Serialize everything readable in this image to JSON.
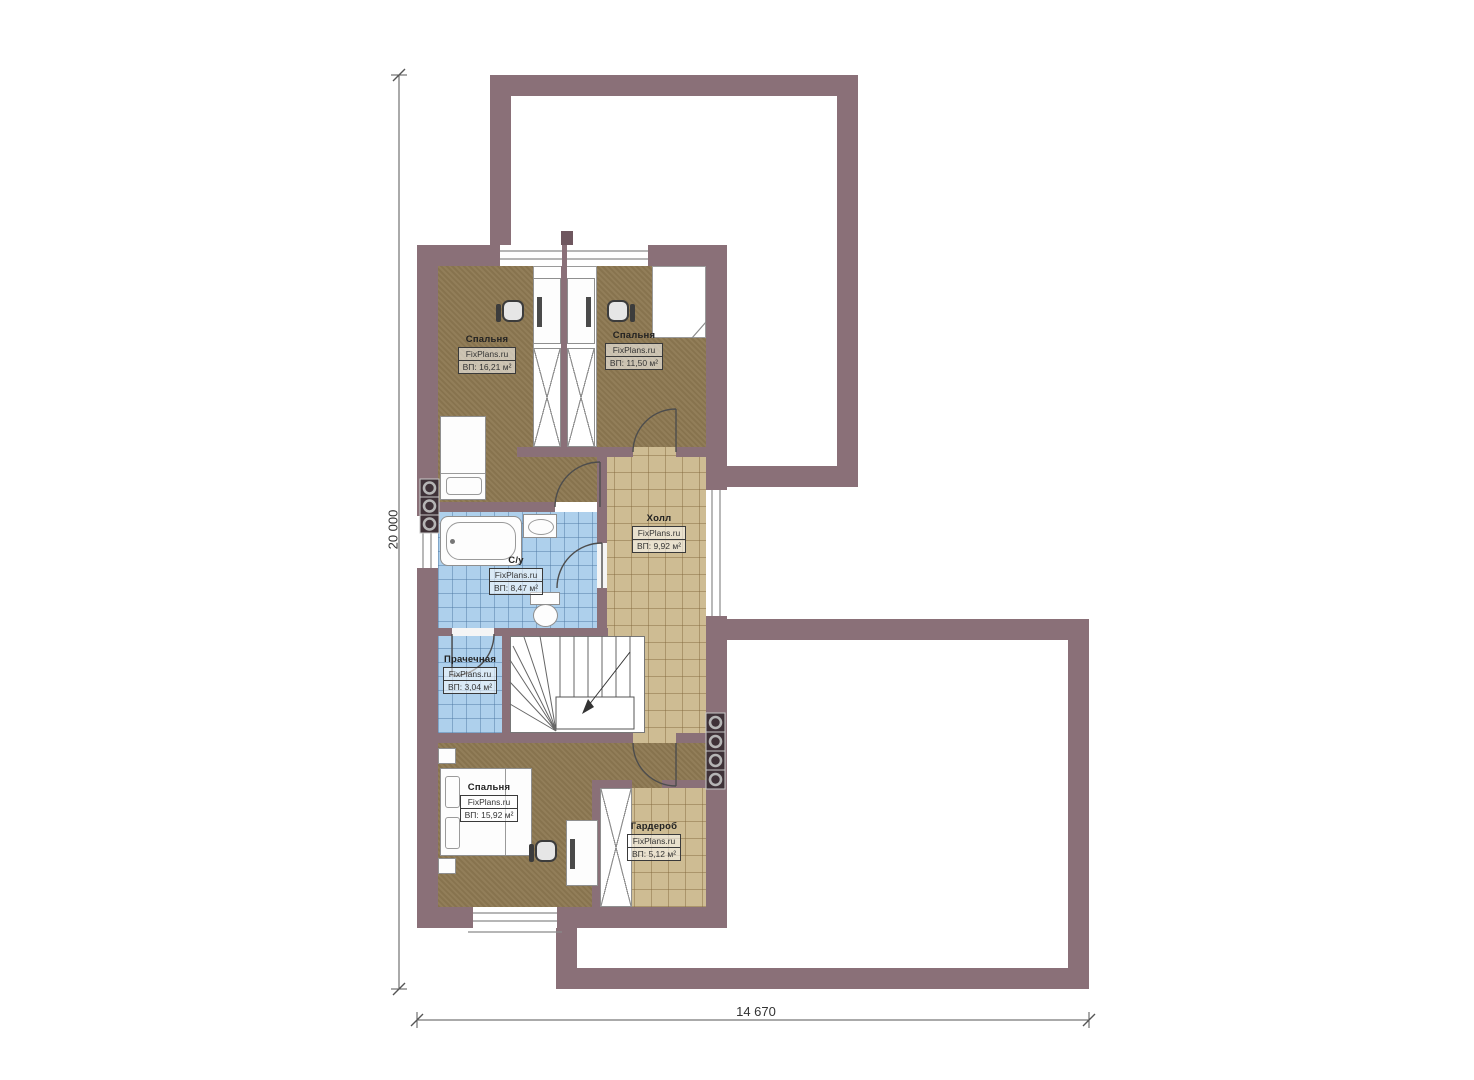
{
  "plan": {
    "rooms": [
      {
        "id": "bedroom-top-left",
        "name": "Спальня",
        "brand": "FixPlans.ru",
        "area": "ВП: 16,21 м²"
      },
      {
        "id": "bedroom-top-right",
        "name": "Спальня",
        "brand": "FixPlans.ru",
        "area": "ВП: 11,50 м²"
      },
      {
        "id": "hall",
        "name": "Холл",
        "brand": "FixPlans.ru",
        "area": "ВП: 9,92 м²"
      },
      {
        "id": "bathroom",
        "name": "С/у",
        "brand": "FixPlans.ru",
        "area": "ВП: 8,47 м²"
      },
      {
        "id": "laundry",
        "name": "Прачечная",
        "brand": "FixPlans.ru",
        "area": "ВП: 3,04 м²"
      },
      {
        "id": "bedroom-bottom",
        "name": "Спальня",
        "brand": "FixPlans.ru",
        "area": "ВП: 15,92 м²"
      },
      {
        "id": "wardrobe",
        "name": "Гардероб",
        "brand": "FixPlans.ru",
        "area": "ВП: 5,12 м²"
      }
    ],
    "dimensions": {
      "height_label": "20 000",
      "width_label": "14 670"
    },
    "colors": {
      "wall": "#8a7078",
      "floor_carpet": "#8e7952",
      "tile_tan": "#cebc93",
      "tile_blue": "#aed0ec"
    }
  }
}
